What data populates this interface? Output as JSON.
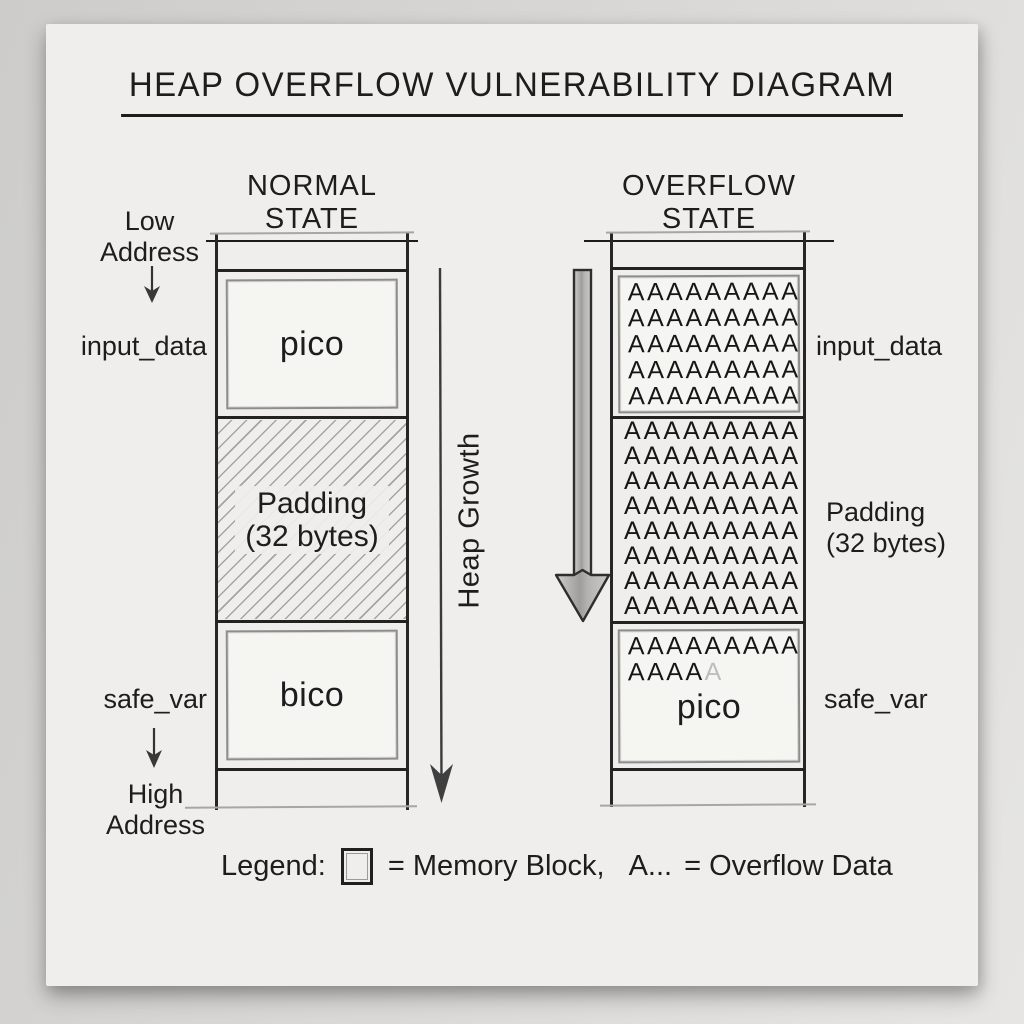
{
  "title": "HEAP OVERFLOW VULNERABILITY DIAGRAM",
  "panels": {
    "normal": {
      "header": "NORMAL STATE",
      "input_block": {
        "label": "input_data",
        "content": "pico"
      },
      "padding_block": {
        "line1": "Padding",
        "line2": "(32 bytes)"
      },
      "safe_block": {
        "label": "safe_var",
        "content": "bico"
      }
    },
    "overflow": {
      "header": "OVERFLOW STATE",
      "input_label": "input_data",
      "padding_label_line1": "Padding",
      "padding_label_line2": "(32 bytes)",
      "safe_label": "safe_var",
      "input_rows": [
        "AAAAAAAAA",
        "AAAAAAAAA",
        "AAAAAAAAA",
        "AAAAAAAAA",
        "AAAAAAAAA"
      ],
      "padding_rows": [
        "AAAAAAAAA",
        "AAAAAAAAA",
        "AAAAAAAAA",
        "AAAAAAAAA",
        "AAAAAAAAA",
        "AAAAAAAAA",
        "AAAAAAAAA",
        "AAAAAAAAA"
      ],
      "safe_full_row": "AAAAAAAAA",
      "safe_partial_dark": "AAAA",
      "safe_partial_faded": "A",
      "safe_content": "pico"
    }
  },
  "address": {
    "low_line1": "Low",
    "low_line2": "Address",
    "high_line1": "High",
    "high_line2": "Address"
  },
  "heap_growth_label": "Heap Growth",
  "legend": {
    "label": "Legend:",
    "memory_block_text": "= Memory Block,",
    "overflow_sample": "A...",
    "overflow_text": "= Overflow Data"
  },
  "colors": {
    "ink": "#1d1d1d",
    "pencil": "#8d8d8b",
    "paper": "#efeeec",
    "wall": "#d3d2d0"
  }
}
